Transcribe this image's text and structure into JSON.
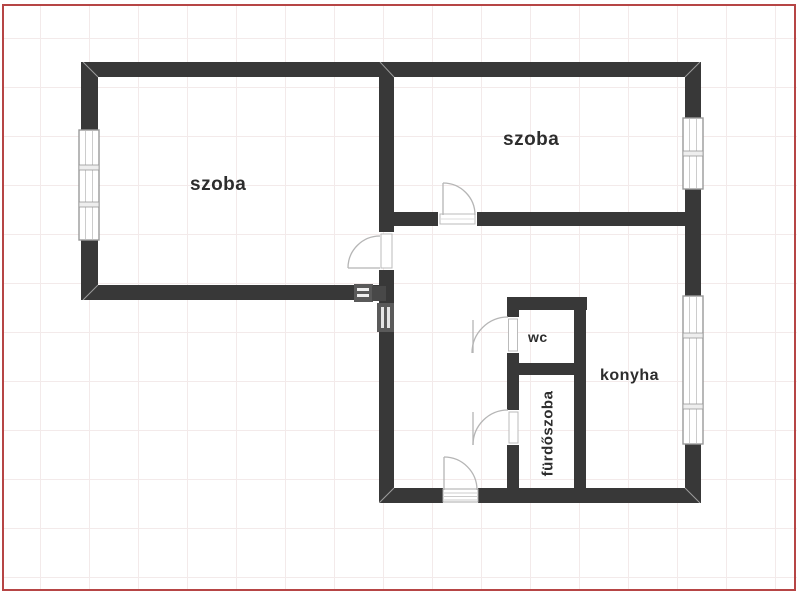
{
  "title": "apartment-floorplan",
  "rooms": {
    "left_bedroom": {
      "label": "szoba"
    },
    "right_bedroom": {
      "label": "szoba"
    },
    "wc": {
      "label": "wc"
    },
    "bathroom": {
      "label": "fürdőszoba"
    },
    "kitchen": {
      "label": "konyha"
    }
  },
  "colors": {
    "wall": "#383838",
    "frame_border": "#b64545",
    "grid_line": "#f3eaea",
    "background": "#ffffff",
    "door_arc": "#b5b5b5",
    "window_frame": "#999999",
    "label_text": "#2d2d2d"
  },
  "icons": [
    {
      "name": "watermark-logo",
      "description": "gray stamp with white bars on wall junction"
    }
  ]
}
